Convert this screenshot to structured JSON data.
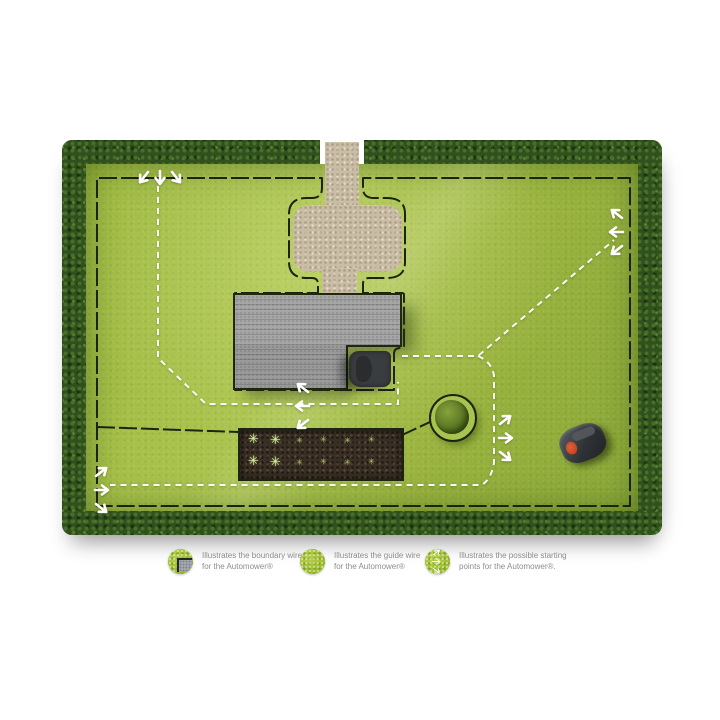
{
  "legend": {
    "items": [
      {
        "icon": "boundary-wire-legend-icon",
        "line": "Illustrates the boundary wire\nfor the Automower®"
      },
      {
        "icon": "guide-wire-legend-icon",
        "line": "Illustrates the guide wire\nfor the Automower®"
      },
      {
        "icon": "starting-points-legend-icon",
        "line": "Illustrates the possible starting\npoints for the Automower®."
      }
    ],
    "icon_color": "#a8c437",
    "text_color": "#8d8d8d"
  },
  "scene": {
    "colors": {
      "lawn": "#a4bd4b",
      "hedge": "#30501d",
      "gravel": "#c9bda6",
      "roof": "#9b9b9b",
      "soil": "#3a2f25",
      "boundary_wire": "#1c2410",
      "guide_wire": "#ffffff",
      "mower_accent": "#cf4a22"
    },
    "starting_point_groups": 5
  }
}
